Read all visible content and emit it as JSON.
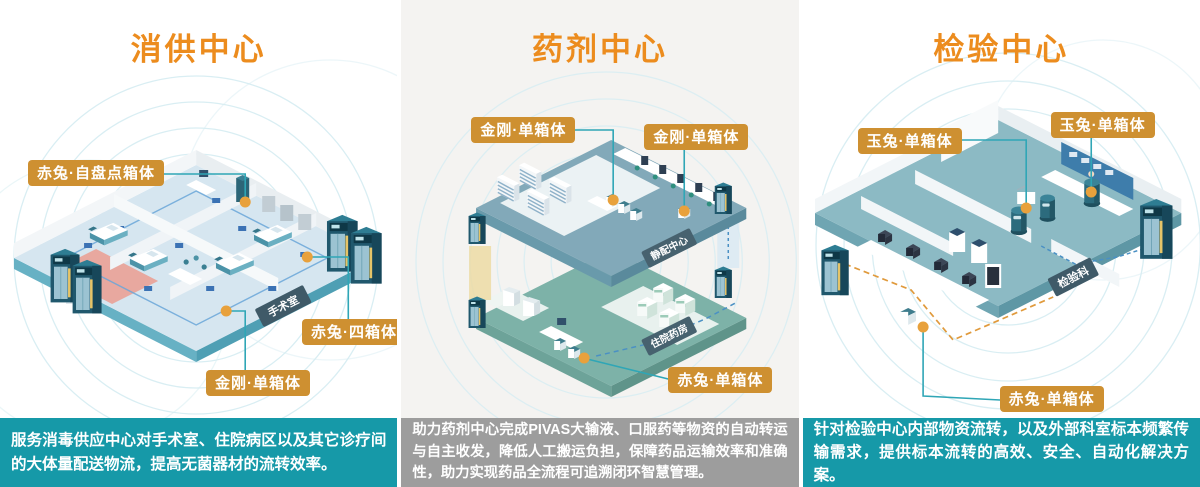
{
  "colors": {
    "title_orange": "#EC8C1E",
    "label_amber": "#CE9031",
    "caption_teal": "#1699A8",
    "caption_gray": "#9D9D9D",
    "callout_line": "#2FA6B6",
    "callout_dot": "#E8A13C",
    "ripple": "#D9EEF3",
    "panel2_bg": "#F4F3F1"
  },
  "panels": [
    {
      "id": "disinfection-supply-center",
      "title": "消供中心",
      "labels": [
        "赤兔·自盘点箱体",
        "赤兔·四箱体",
        "金刚·单箱体"
      ],
      "scene_tags": [
        "手术室"
      ],
      "caption": "服务消毒供应中心对手术室、住院病区以及其它诊疗间的大体量配送物流，提高无菌器材的流转效率。"
    },
    {
      "id": "pharmacy-center",
      "title": "药剂中心",
      "labels": [
        "金刚·单箱体",
        "金刚·单箱体",
        "赤兔·单箱体"
      ],
      "scene_tags": [
        "静配中心",
        "住院药房"
      ],
      "caption": "助力药剂中心完成PIVAS大输液、口服药等物资的自动转运与自主收发，降低人工搬运负担，保障药品运输效率和准确性，助力实现药品全流程可追溯闭环智慧管理。"
    },
    {
      "id": "laboratory-center",
      "title": "检验中心",
      "labels": [
        "玉兔·单箱体",
        "玉兔·单箱体",
        "赤兔·单箱体"
      ],
      "scene_tags": [
        "检验科"
      ],
      "caption": "针对检验中心内部物资流转，以及外部科室标本频繁传输需求，提供标本流转的高效、安全、自动化解决方案。"
    }
  ]
}
